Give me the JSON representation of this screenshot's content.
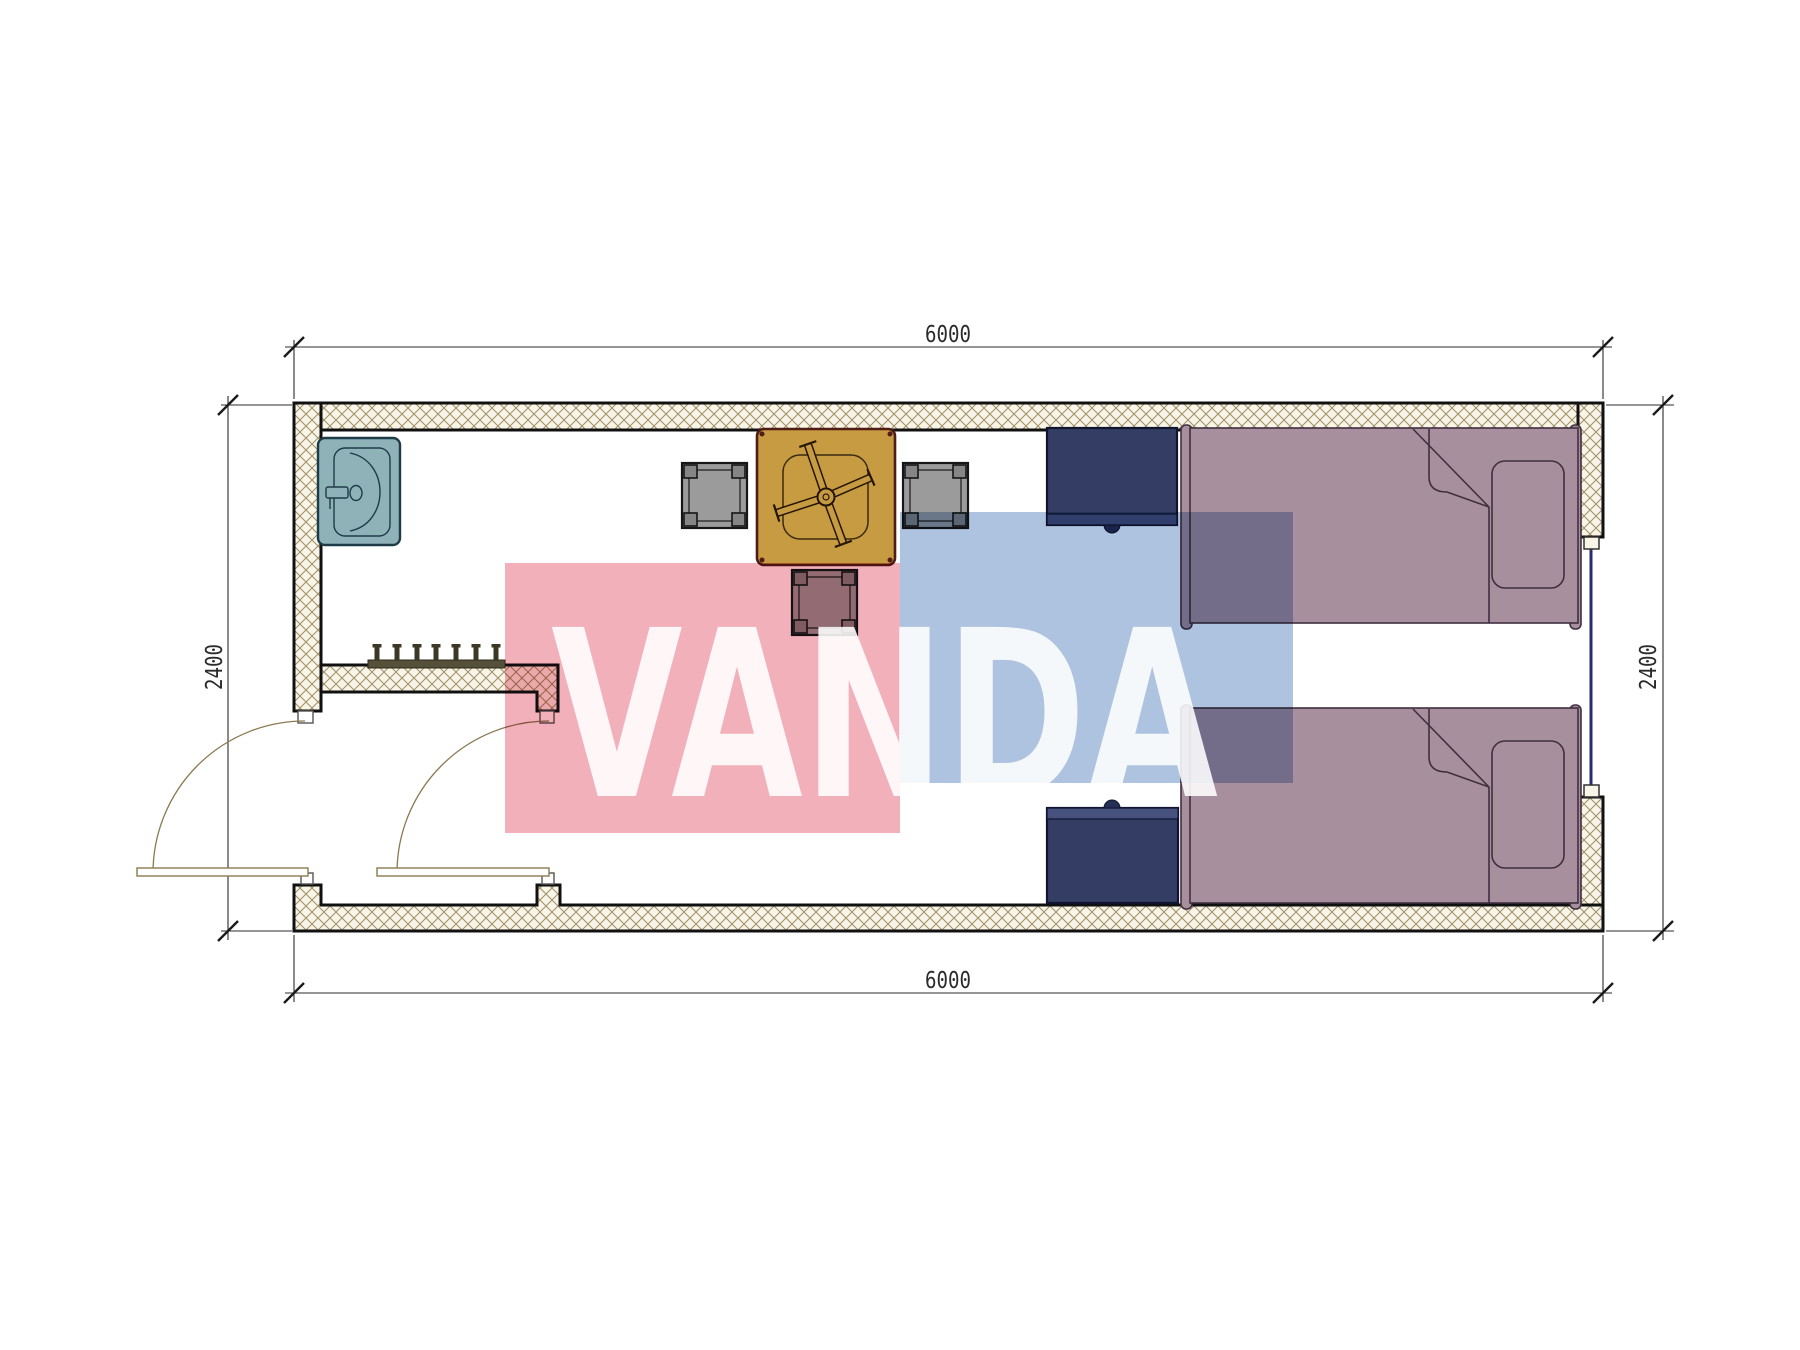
{
  "drawing": {
    "kind": "floor-plan",
    "watermark": {
      "text": "VANDA",
      "pink_color": "#f2b0bb",
      "blue_color": "#aec3df",
      "text_color": "rgba(255,255,255,0.88)"
    },
    "dimensions": {
      "width_top": "6000",
      "width_bottom": "6000",
      "height_left": "2400",
      "height_right": "2400"
    },
    "colors": {
      "wall_hatch_bg": "#f8f4e7",
      "wall_hatch_line": "#8d7c4e",
      "wall_outline": "#111111",
      "dimension_ink": "#2b2b2b",
      "sink": "#8fb1b8",
      "sink_outline": "#1e3c48",
      "table": "#c79b41",
      "table_outline": "#4f1d15",
      "chair": "#9b9b9b",
      "nightstand": "#343e65",
      "nightstand_band": "#46517e",
      "bed": "#a88f9d",
      "bed_outline": "#3f3040",
      "window_glass": "#2a2a72",
      "door_swing": "#8a7a50",
      "hook_bar": "#55503a"
    },
    "furniture": [
      {
        "name": "wash-basin"
      },
      {
        "name": "coat-hooks"
      },
      {
        "name": "dining-table"
      },
      {
        "name": "chair-left"
      },
      {
        "name": "chair-right"
      },
      {
        "name": "chair-bottom"
      },
      {
        "name": "nightstand-top"
      },
      {
        "name": "nightstand-bottom"
      },
      {
        "name": "single-bed-top"
      },
      {
        "name": "single-bed-bottom"
      },
      {
        "name": "window-right"
      },
      {
        "name": "entry-door"
      },
      {
        "name": "interior-door"
      }
    ]
  }
}
